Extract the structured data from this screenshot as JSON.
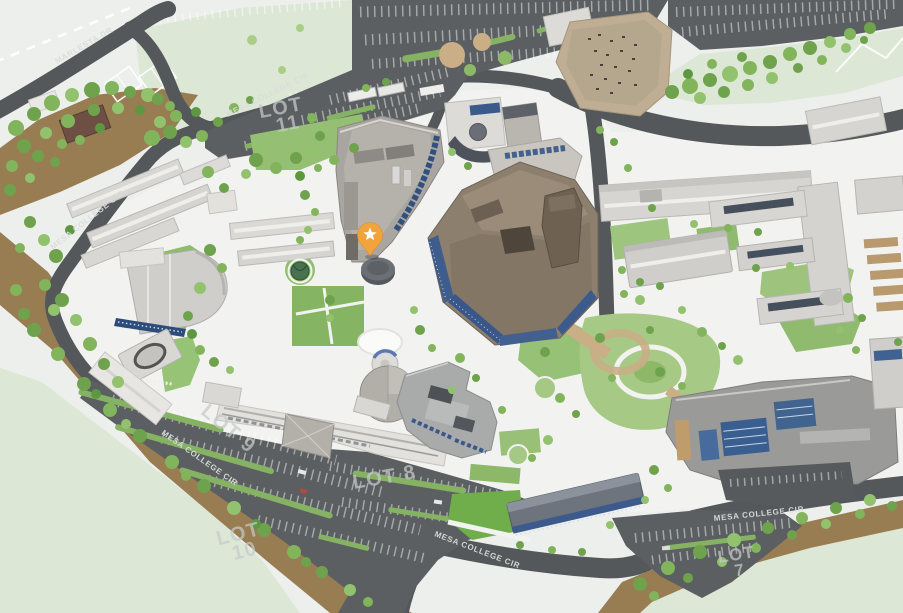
{
  "map": {
    "title": "campus-map",
    "marker": {
      "id": "selected-location-pin",
      "icon": "star-pin-icon",
      "color": "#F2A43C",
      "star_color": "#FFFFFF"
    },
    "street_labels": [
      {
        "id": "marlesta-dr",
        "text": "MARLESTA DR"
      },
      {
        "id": "mesa-college-cir-top",
        "text": "MESA COLLEGE CIR"
      },
      {
        "id": "mesa-college-cir-west",
        "text": "MESA COLLEGE CIR"
      },
      {
        "id": "mesa-college-cir-southwest",
        "text": "MESA COLLEGE CIR"
      },
      {
        "id": "mesa-college-cir-south",
        "text": "MESA COLLEGE CIR"
      },
      {
        "id": "mesa-college-cir-southeast",
        "text": "MESA COLLEGE CIR"
      }
    ],
    "parking_lots": [
      {
        "id": "lot-11",
        "line1": "LOT",
        "line2": "11"
      },
      {
        "id": "lot-9",
        "line1": "LOT 9",
        "line2": ""
      },
      {
        "id": "lot-10",
        "line1": "LOT",
        "line2": "10"
      },
      {
        "id": "lot-8",
        "line1": "LOT 8",
        "line2": ""
      },
      {
        "id": "lot-7",
        "line1": "LOT",
        "line2": "7"
      }
    ],
    "colors": {
      "background": "#EDEFED",
      "road": "#54585A",
      "parking": "#5B5F61",
      "campus_ground": "#F2F3F0",
      "open_land": "#DCE7D6",
      "hillside": "#987D53",
      "lawn": "#8FBA6C",
      "window_blue": "#3A578A",
      "marker": "#F2A43C"
    }
  }
}
